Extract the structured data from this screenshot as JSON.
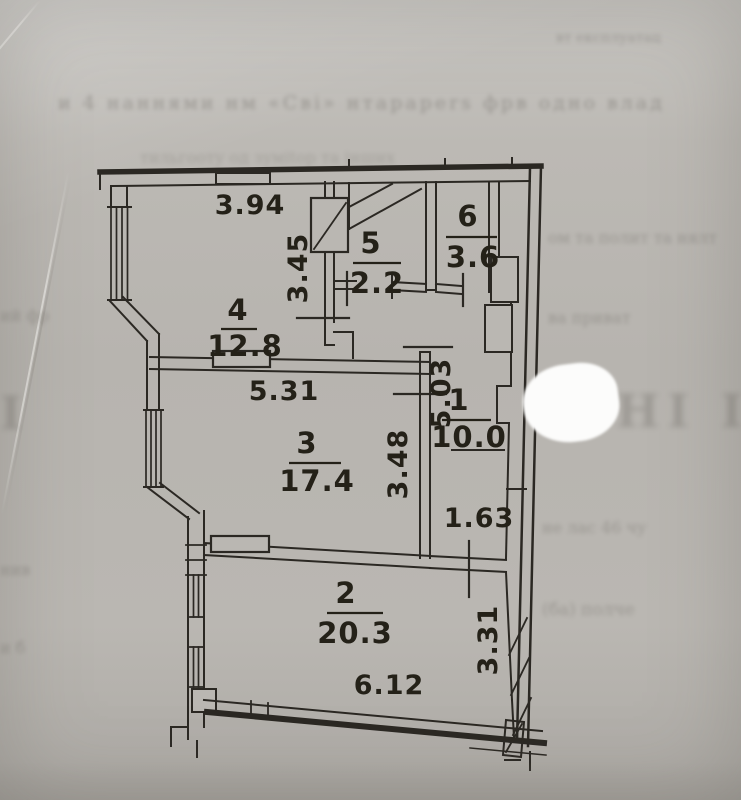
{
  "document": {
    "description": "Scanned apartment floor plan (technical passport drawing) on gray paper"
  },
  "rooms": {
    "r1": {
      "number": "1",
      "area": "10.0"
    },
    "r2": {
      "number": "2",
      "area": "20.3"
    },
    "r3": {
      "number": "3",
      "area": "17.4"
    },
    "r4": {
      "number": "4",
      "area": "12.8"
    },
    "r5": {
      "number": "5",
      "area": "2.2"
    },
    "r6": {
      "number": "6",
      "area": "3.6"
    }
  },
  "dims": {
    "d394": "3.94",
    "d345": "3.45",
    "d531": "5.31",
    "d503": "5.03",
    "d348": "3.48",
    "d163": "1.63",
    "d612": "6.12",
    "d331": "3.31"
  },
  "bleed": {
    "top_right": "вт експлуатац",
    "row1": "и 4 наннями нм «Сві» нтаpapers фрв одно влад",
    "row2": "тильгооту од зуміtop та інших",
    "row3": "ом та полит та нялт",
    "row4_left": "ий фр",
    "row4_right": "ва приват",
    "big_left": "І",
    "big_right": "НІ ІАС",
    "row5": "не лас 46 чу",
    "row6": "нив",
    "row7": "(ба) полче",
    "row8": "и б"
  },
  "colors": {
    "paper": "#b8b5b0",
    "ink": "#2b2823",
    "blob": "#fcfcfb"
  }
}
